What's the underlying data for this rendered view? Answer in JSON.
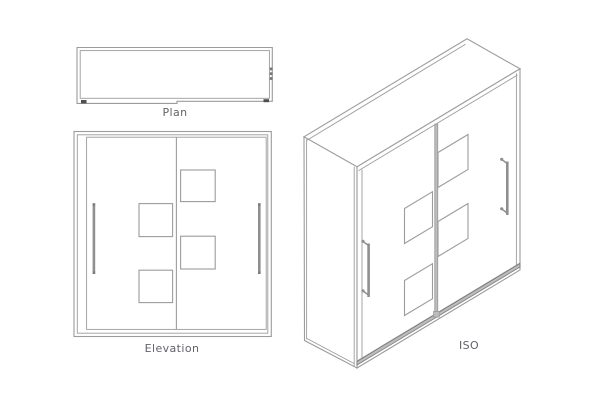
{
  "colors": {
    "background": "#ffffff",
    "line": "#9c9c9c",
    "line-dark": "#7d7d7d",
    "handle": "#8f8f8f",
    "track": "#bcbcbc",
    "dark": "#4f4f4f",
    "text": "#5f6368"
  },
  "views": {
    "plan": {
      "label": "Plan"
    },
    "elevation": {
      "label": "Elevation"
    },
    "iso": {
      "label": "ISO"
    }
  }
}
